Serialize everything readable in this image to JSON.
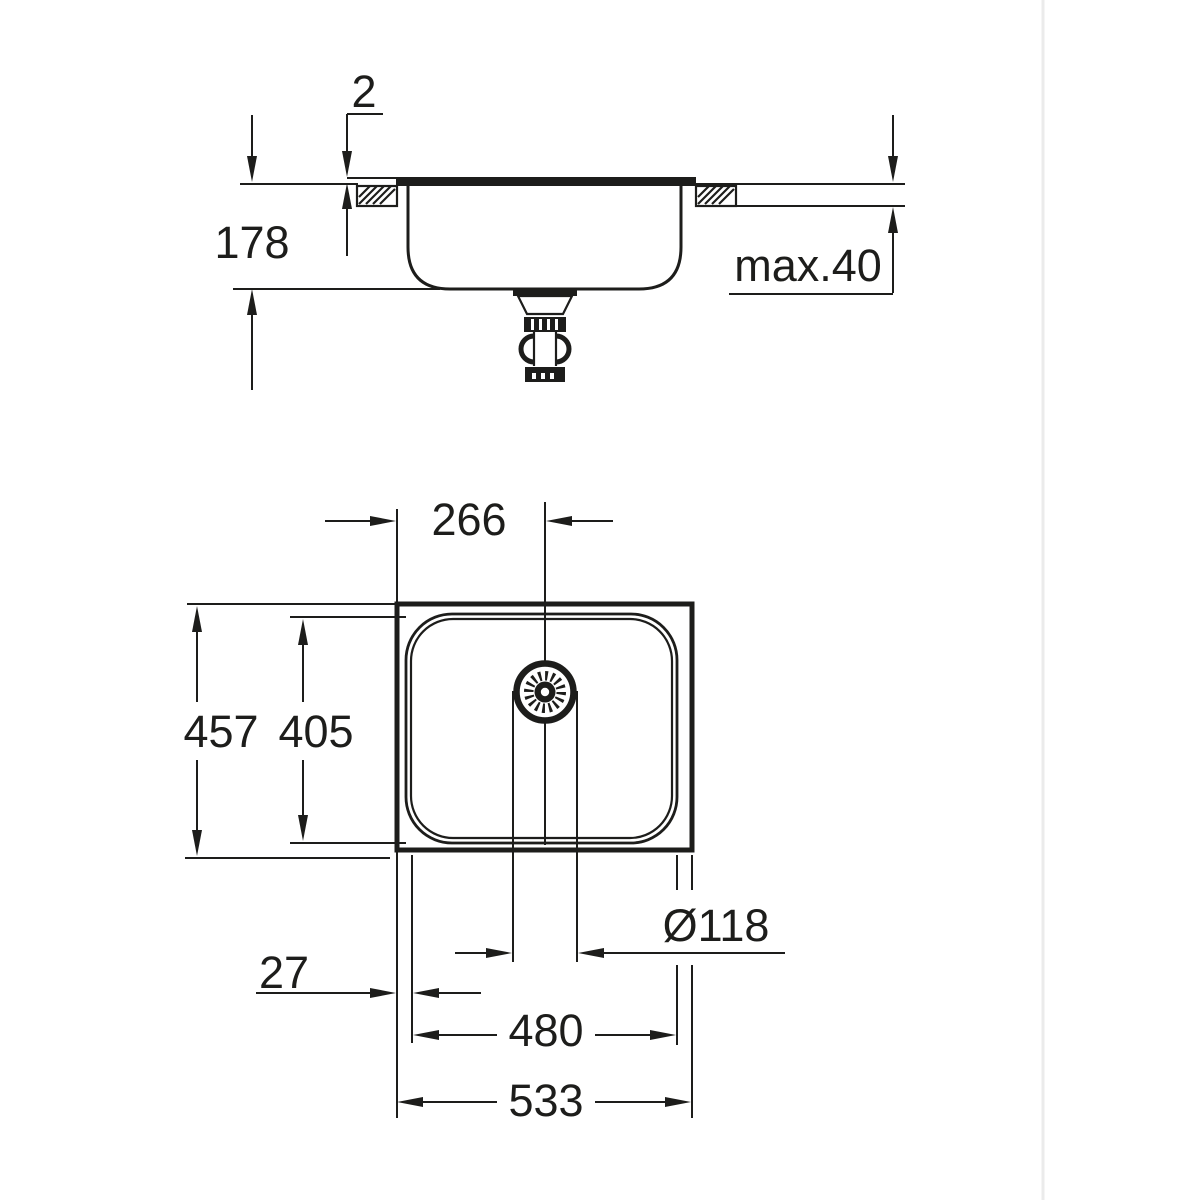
{
  "page": {
    "background_color": "#ffffff",
    "line_color": "#1d1d1b",
    "scan_edge_color": "#ebebeb"
  },
  "side_view": {
    "dims": {
      "rim_height": "2",
      "depth": "178",
      "counter_thickness": "max.40"
    }
  },
  "plan_view": {
    "dims": {
      "drain_from_left": "266",
      "overall_depth": "457",
      "bowl_depth": "405",
      "edge_to_bowl": "27",
      "bowl_width": "480",
      "overall_width": "533",
      "drain_diameter": "Ø118"
    }
  }
}
